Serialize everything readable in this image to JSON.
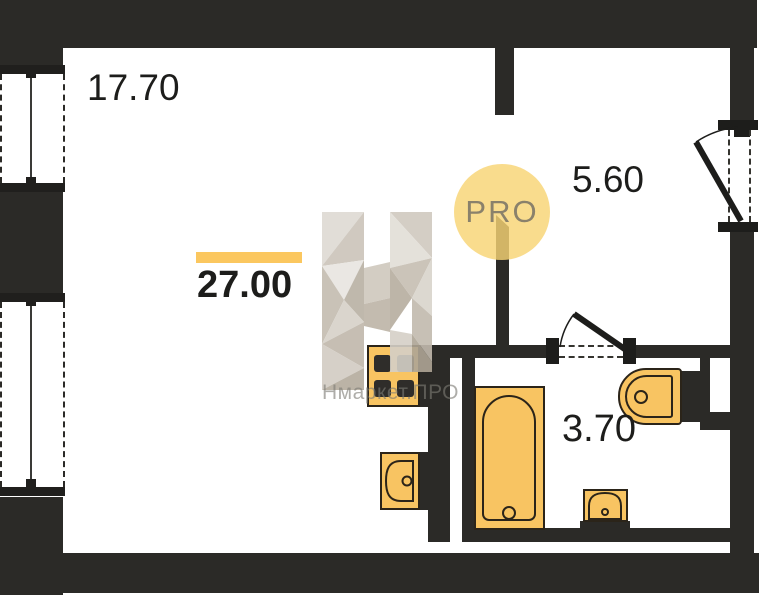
{
  "plan": {
    "total_area_label": "27.00",
    "rooms": [
      {
        "name": "living-room",
        "area": "17.70"
      },
      {
        "name": "hallway",
        "area": "5.60"
      },
      {
        "name": "bathroom",
        "area": "3.70"
      }
    ],
    "watermark": {
      "circle_text": "PRO",
      "brand": "Нмаркет.ПРО"
    },
    "fixtures": [
      "window",
      "window",
      "stove",
      "kitchen-sink",
      "bathtub",
      "wash-basin",
      "toilet",
      "entry-door",
      "bathroom-door"
    ],
    "colors": {
      "wall": "#2b2a27",
      "fixture": "#f8c462",
      "accent_bar": "#fbc75f",
      "pro_circle": "#f8d474",
      "watermark_text": "#7d7a74"
    }
  }
}
